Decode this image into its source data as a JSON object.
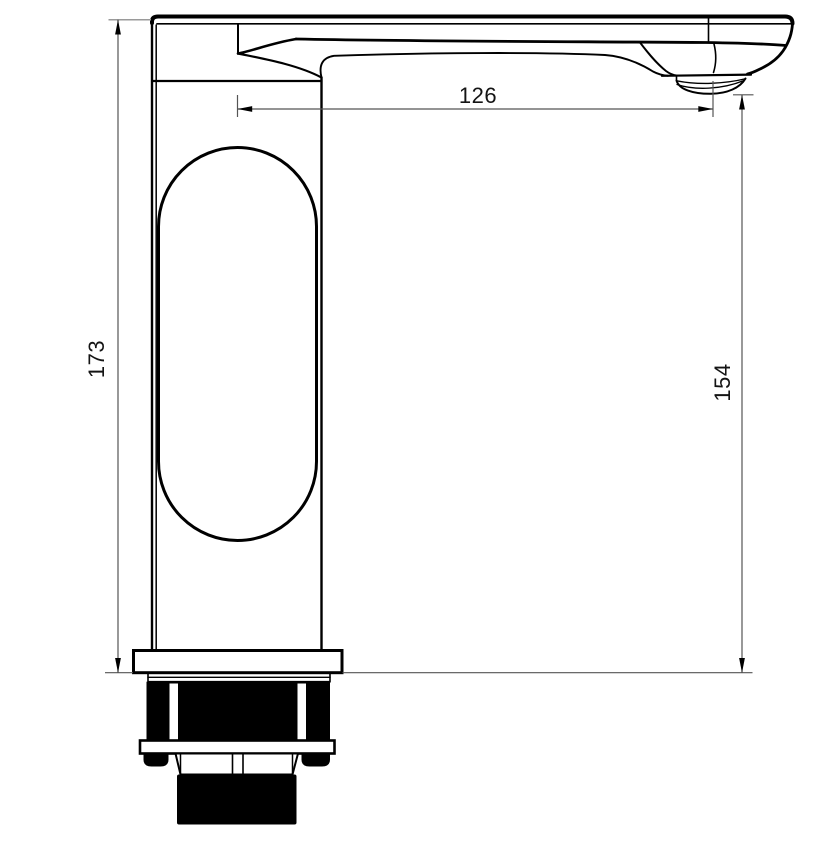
{
  "drawing": {
    "kind": "technical-dimension-drawing",
    "subject": "tall-basin-faucet-side-view",
    "dimensions": {
      "overall_height": "173",
      "spout_reach": "126",
      "spout_height": "154"
    },
    "colors": {
      "outline": "#000000",
      "dimension_line": "#555555",
      "extension_line": "#9a9a9a",
      "background": "#ffffff"
    }
  }
}
